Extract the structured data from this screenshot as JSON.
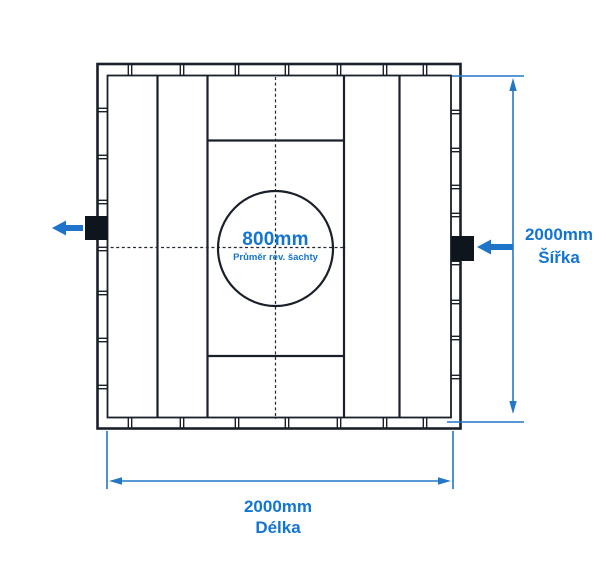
{
  "drawing": {
    "shaft": {
      "diameter": "800mm",
      "caption": "Průměr rev. šachty"
    },
    "width_dimension": {
      "value": "2000mm",
      "label": "Šířka"
    },
    "length_dimension": {
      "value": "2000mm",
      "label": "Délka"
    }
  },
  "colors": {
    "line_black": "#1a202a",
    "fitting_black": "#0e151c",
    "dimension_blue": "#2277c9",
    "text_blue": "#1375d2"
  }
}
